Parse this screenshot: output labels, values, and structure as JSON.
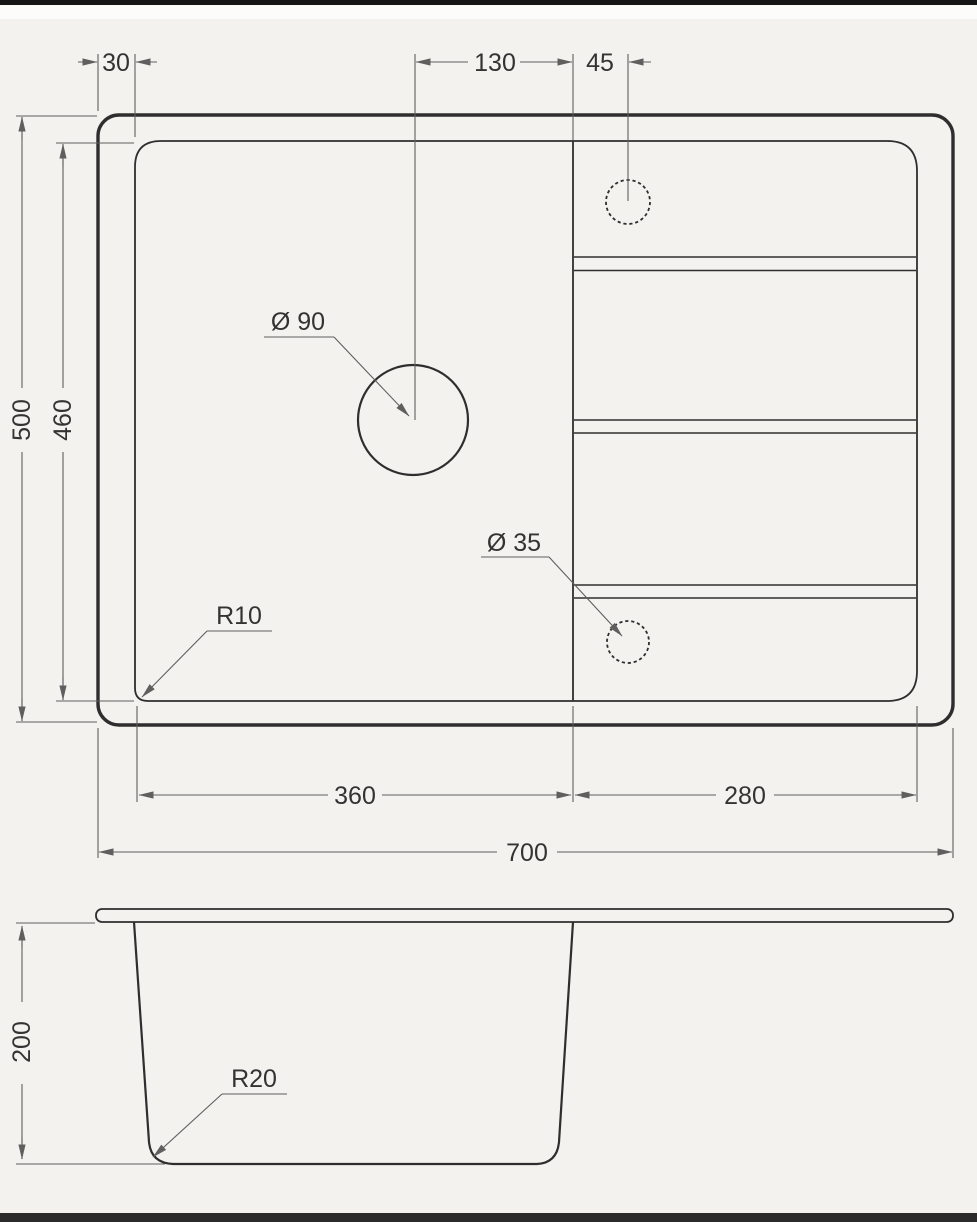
{
  "labels": {
    "dim_30": "30",
    "dim_130": "130",
    "dim_45": "45",
    "dim_500": "500",
    "dim_460": "460",
    "dia_90": "Ø 90",
    "dia_35": "Ø 35",
    "r10": "R10",
    "dim_360": "360",
    "dim_280": "280",
    "dim_700": "700",
    "dim_200": "200",
    "r20": "R20"
  },
  "values": {
    "rim_offset": 30,
    "drain_center_to_divider": 130,
    "tap_hole_offset": 45,
    "overall_depth": 500,
    "inner_depth": 460,
    "drain_hole_diameter": 90,
    "small_hole_diameter": 35,
    "inner_corner_radius": 10,
    "bowl_length": 360,
    "drainboard_length": 280,
    "overall_length": 700,
    "bowl_height": 200,
    "bottom_corner_radius": 20
  },
  "colors": {
    "background": "#f3f2ef",
    "line": "#2e2e2e",
    "dim": "#5f5f5f",
    "text": "#333333",
    "top_bar": "#161616",
    "bottom_bar": "#2b2b2b",
    "highlight": "#fcfcfb"
  }
}
